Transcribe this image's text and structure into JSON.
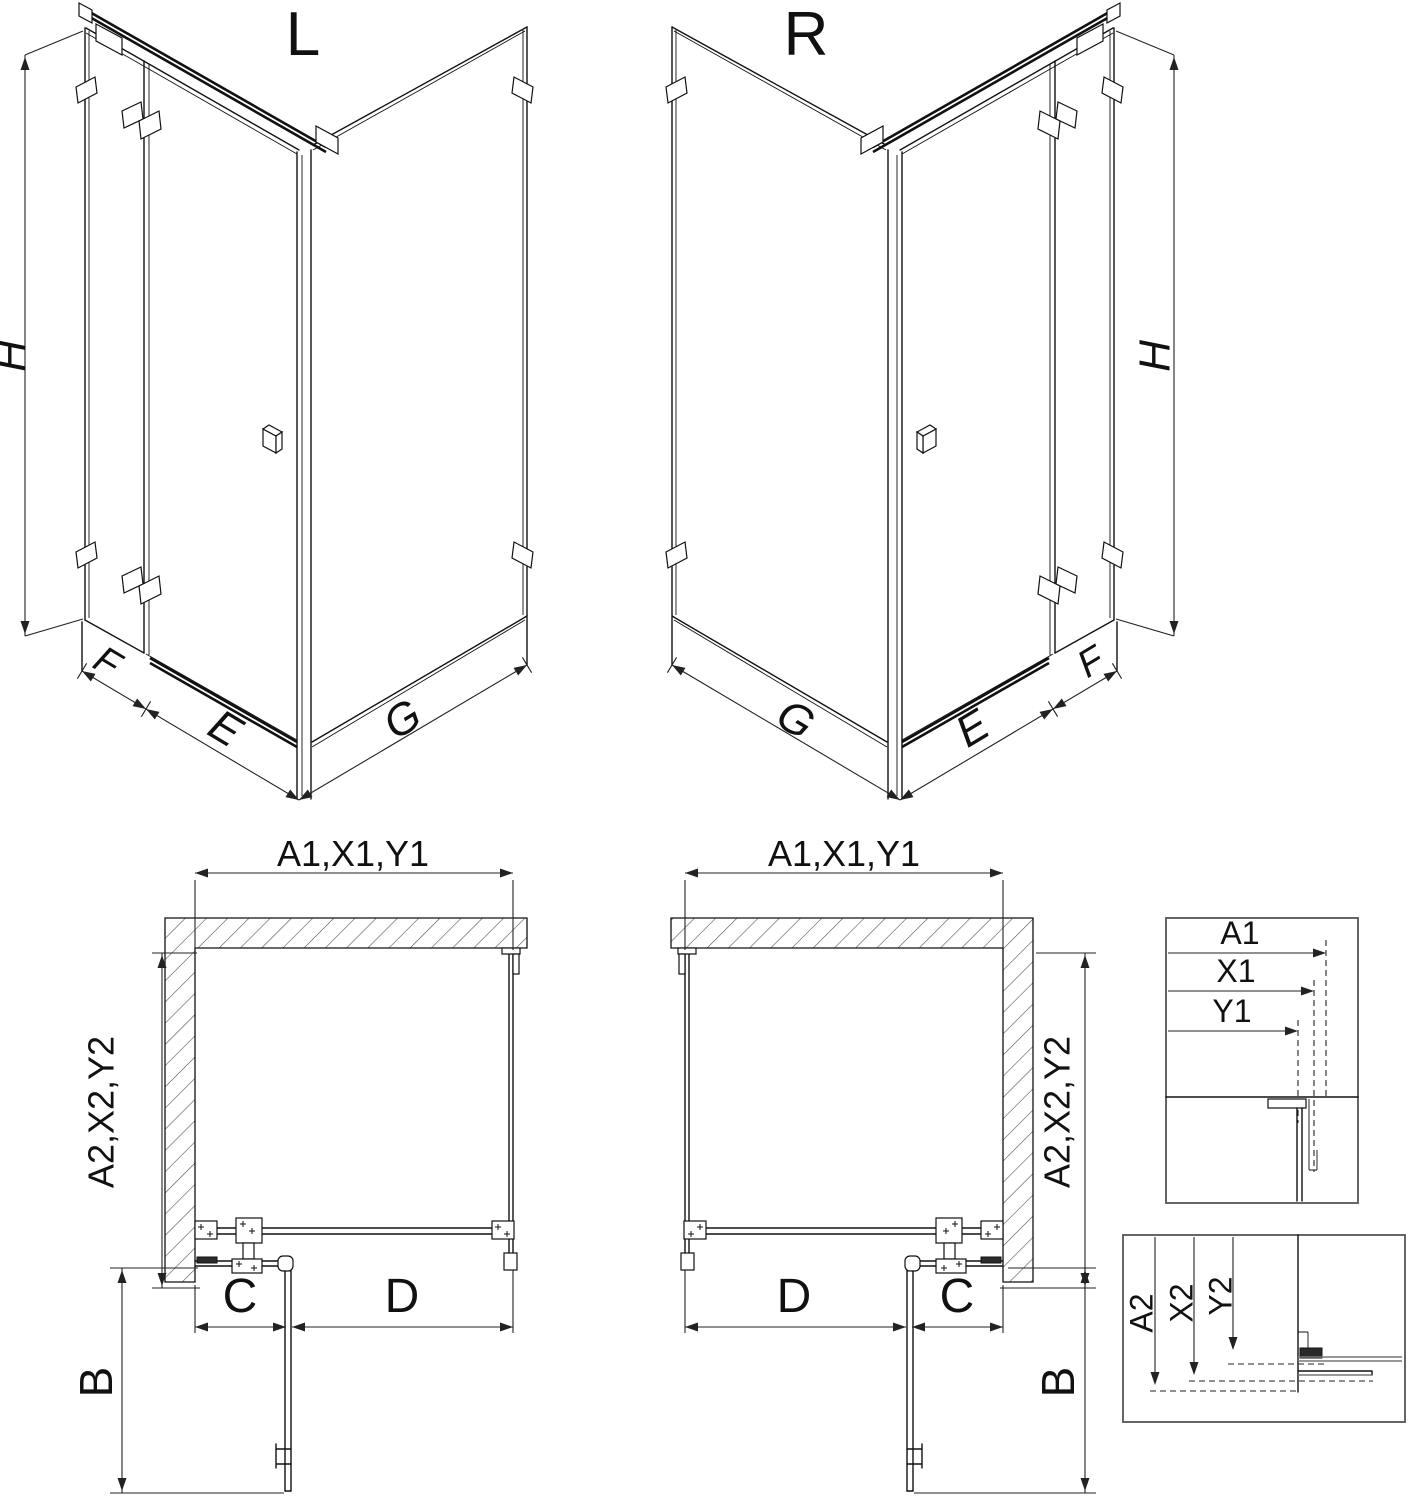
{
  "colors": {
    "line": "#111111",
    "dim_line": "#222222",
    "gray_line": "#777777",
    "box_border": "#555555",
    "background": "#ffffff"
  },
  "iso_left": {
    "title": "L",
    "height_label": "H",
    "fixed_label": "F",
    "door_label": "E",
    "return_label": "G"
  },
  "iso_right": {
    "title": "R",
    "height_label": "H",
    "fixed_label": "F",
    "door_label": "E",
    "return_label": "G"
  },
  "plan_left": {
    "top_dim": "A1,X1,Y1",
    "side_dim": "A2,X2,Y2",
    "b": "B",
    "c": "C",
    "d": "D"
  },
  "plan_right": {
    "top_dim": "A1,X1,Y1",
    "side_dim": "A2,X2,Y2",
    "b": "B",
    "c": "C",
    "d": "D"
  },
  "detail_top": {
    "a1": "A1",
    "x1": "X1",
    "y1": "Y1"
  },
  "detail_bottom": {
    "a2": "A2",
    "x2": "X2",
    "y2": "Y2"
  }
}
